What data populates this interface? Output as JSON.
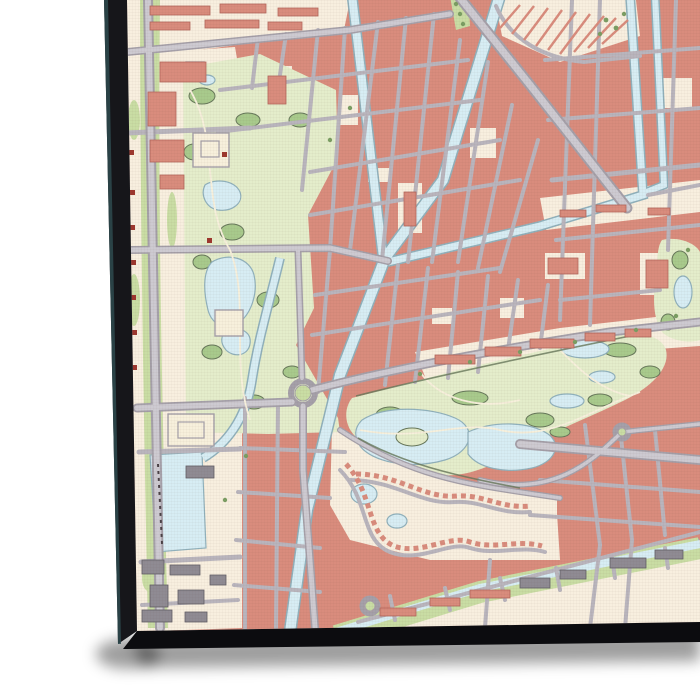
{
  "scene": {
    "description": "Angled gallery-wrapped canvas print of a detailed pastel city street map (no legible labels), photographed on a white background with a soft drop shadow below",
    "page_bg": "#ffffff"
  },
  "canvas_print": {
    "side_left": "#16161a",
    "side_bottom": "#0c0c0f",
    "edge_highlight": "#2e4a4f",
    "shadow": "rgba(0,0,0,0.38)"
  },
  "map": {
    "style": "topographic city map",
    "features": {
      "urban_blocks": "salmon building blocks",
      "roads": "grey street grid with diagonal avenues",
      "canals": "light blue canals and ponds",
      "parks": "two large parks with ponds, lawns and tree clusters",
      "harbor": "small harbor basin with moored boats",
      "greenhouses": "hatched glasshouse rows, top right",
      "village": "curvy garden-village streets below central park",
      "industry": "grey industrial sheds, bottom left"
    },
    "colors": {
      "base_cream": "#f8efdf",
      "block_salmon": "#d98c7d",
      "block_outline": "#b2665a",
      "road_casing": "#a5a0a9",
      "road_fill": "#cdcad1",
      "road_minor": "#b9b5bd",
      "water_fill": "#d7edf4",
      "water_outline": "#90b1bc",
      "park_base": "#e4edcb",
      "park_patch": "#a8ca8c",
      "park_outline": "#66775a",
      "verge_green": "#c9dda4",
      "tree_green": "#7b9e63",
      "building_cream": "#f7f0dc",
      "building_gray": "#8f8b93",
      "building_gray_outline": "#615e66",
      "symbol_red": "#9d372e",
      "boat_dark": "#4a4146"
    }
  }
}
